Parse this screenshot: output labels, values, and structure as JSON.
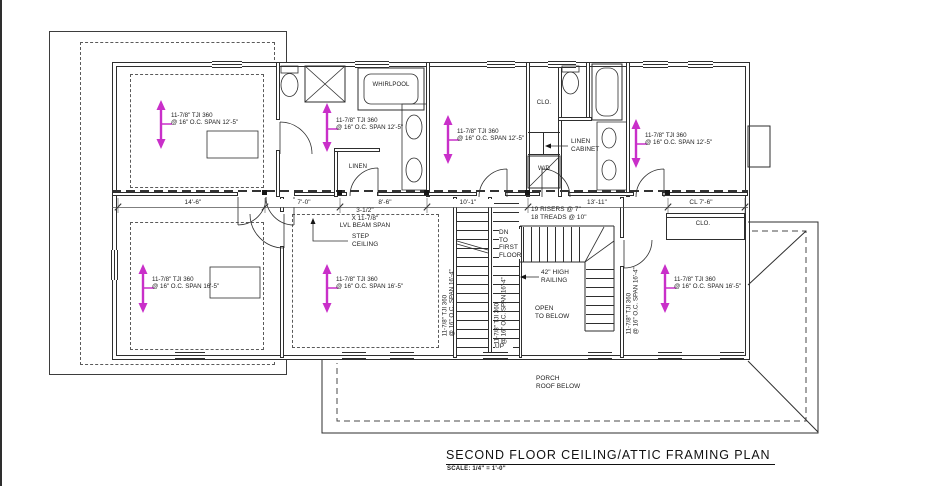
{
  "title": {
    "text": "SECOND FLOOR CEILING/ATTIC FRAMING PLAN",
    "scale": "SCALE: 1/4\" = 1'-0\""
  },
  "colors": {
    "line": "#2e2e2e",
    "joist_arrow": "#c92fc9"
  },
  "joist_notes": {
    "tji": "11-7/8\" TJI 360",
    "span_12_5": "@ 16\" O.C. SPAN 12'-5\"",
    "span_16_5": "@ 16\" O.C. SPAN 16'-5\"",
    "span_16_4": "@ 16\" O.C. SPAN 16'-4\""
  },
  "rooms": {
    "wic_his_clg": "8'-0\" CLG.\nHEIGHT",
    "wic_his": "WALK IN CLOSET\nHIS",
    "master_bath": "MASTER\nBATH",
    "bedroom4": "BEDROOM 4",
    "bedroom2": "BEDROOM 2",
    "master_bedroom": "MASTER\nBEDROOM",
    "wic_lower": "8'-0\" CLG.\nHEIGHT\nWALK IN CLOSET",
    "bedroom3": "BEDROOM 3",
    "porch": "PORCH\nROOF BELOW"
  },
  "fixtures": {
    "whirlpool": "WHIRLPOOL",
    "linen": "LINEN",
    "linen_cabinet": "LINEN\nCABINET",
    "wd": "W/D",
    "clo_bath": "CLO.",
    "clo_bedroom3": "CLO."
  },
  "stairs": {
    "risers": "19 RISERS @ 7\"",
    "treads": "18 TREADS @ 10\"",
    "dn": "DN\nTO\nFIRST\nFLOOR",
    "railing": "42\" HIGH\nRAILING",
    "open_below": "OPEN\nTO BELOW",
    "up": "UP"
  },
  "beam": {
    "note": "3-1/2\"\nX 11-7/8\"\nLVL BEAM SPAN",
    "step": "STEP\nCEILING"
  },
  "dimensions": [
    "14'-6\"",
    "7'-0\"",
    "8'-6\"",
    "10'-1\"",
    "13'-11\"",
    "CL 7'-6\""
  ]
}
